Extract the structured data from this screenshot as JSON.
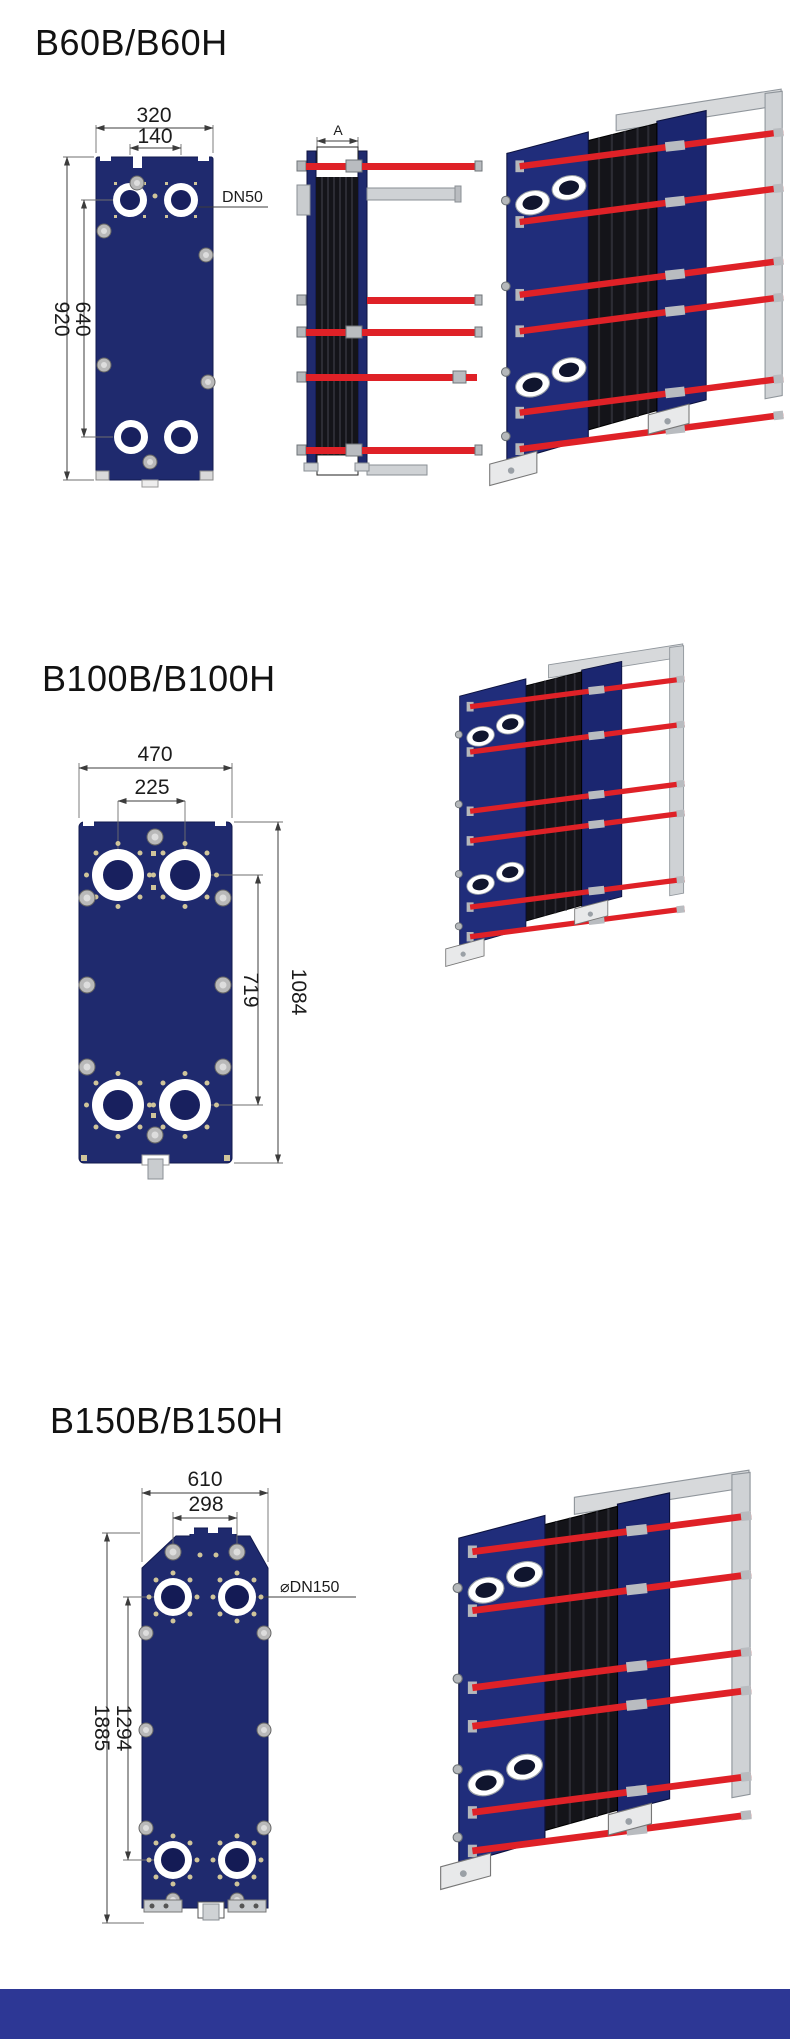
{
  "colors": {
    "plate_navy": "#1f2a6e",
    "frame_navy": "#202d7b",
    "pack_black": "#141419",
    "rod_red": "#df2127",
    "metal_gray": "#c9cccf",
    "bolt_cream": "#cfc49a",
    "dim_line": "#3c3c3c",
    "footer_blue": "#2d3795"
  },
  "sections": [
    {
      "title": "B60B/B60H",
      "front_view": {
        "width_outer": "320",
        "width_inner": "140",
        "height_outer": "920",
        "height_inner": "640",
        "port_label": "DN50"
      },
      "side_view": {
        "length_label": "A"
      }
    },
    {
      "title": "B100B/B100H",
      "front_view": {
        "width_outer": "470",
        "width_inner": "225",
        "height_outer": "1084",
        "height_inner": "719"
      }
    },
    {
      "title": "B150B/B150H",
      "front_view": {
        "width_outer": "610",
        "width_inner": "298",
        "height_outer": "1885",
        "height_inner": "1294",
        "port_label": "⌀DN150"
      }
    }
  ]
}
